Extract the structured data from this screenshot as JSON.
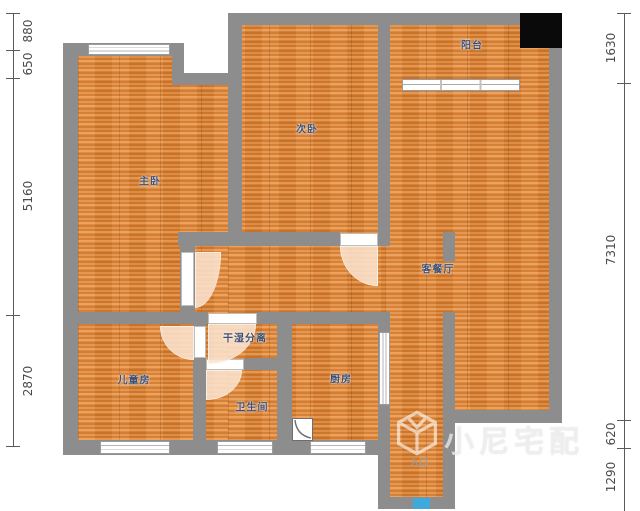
{
  "rooms": [
    {
      "id": "master-bedroom",
      "label": "主卧"
    },
    {
      "id": "second-bedroom",
      "label": "次卧"
    },
    {
      "id": "balcony",
      "label": "阳台"
    },
    {
      "id": "living-dining",
      "label": "客餐厅"
    },
    {
      "id": "dry-wet-separation",
      "label": "干湿分离"
    },
    {
      "id": "children-room",
      "label": "儿童房"
    },
    {
      "id": "kitchen",
      "label": "厨房"
    },
    {
      "id": "bathroom",
      "label": "卫生间"
    },
    {
      "id": "entrance",
      "label": "入口"
    }
  ],
  "dims": {
    "left": [
      "880",
      "650",
      "5160",
      "2870"
    ],
    "right": [
      "1630",
      "7310",
      "620",
      "1290"
    ]
  },
  "watermark": {
    "text": "小尼宅配",
    "logo": "cube-logo"
  },
  "colors": {
    "wall": "#8d8d8d",
    "floor_wood": "#df8a3e",
    "door_arc": "#fae2ce",
    "label_text": "#3f4e6e",
    "entry_marker_blue": "#3fa9dc",
    "black_block": "#0a0a0a"
  }
}
